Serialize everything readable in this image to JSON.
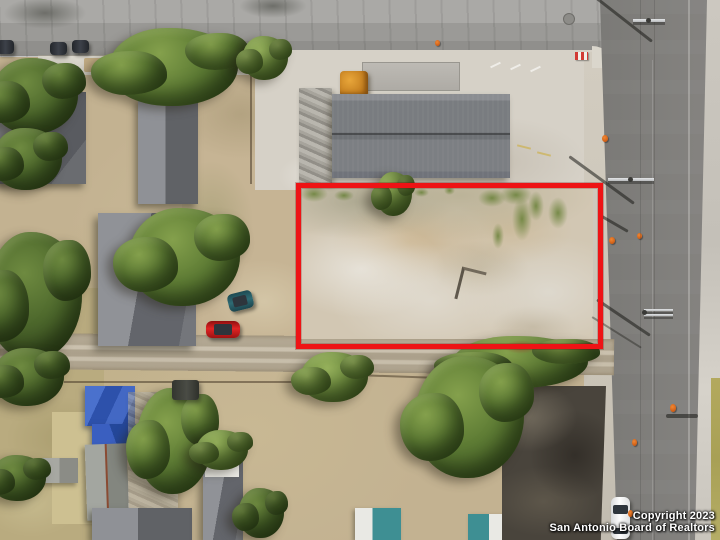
{
  "meta": {
    "type": "aerial-drone-real-estate-photo",
    "description": "Top-down aerial photograph of a vacant dirt lot outlined with a red property-boundary rectangle, bordered by a light horizontal street at top, a dark vertical street at right, residential houses and trees at left and bottom",
    "image_width": 720,
    "image_height": 540
  },
  "watermark": {
    "line1": "Copyright 2023",
    "line2": "San Antonio Board of Realtors",
    "text_color": "#ffffff"
  },
  "boundary": {
    "shape": "rectangle",
    "color": "#ee1315",
    "x": 296,
    "y": 183,
    "width": 297,
    "height": 156,
    "stroke_px": 5
  },
  "palette": {
    "dirt_lot": "#d2c7b3",
    "dirt_yard": "#c6b494",
    "dry_grass": "#b9ab7f",
    "road_top": "#9b9a97",
    "road_right": "#6a6967",
    "sidewalk": "#dad6cc",
    "concrete_pad": "#d6d1c7",
    "roof_main": "#797c80",
    "roof_dark": "#595b60",
    "flat_roof": "#49443c",
    "tarp_blue": "#3a5fc0",
    "tree_green": "#5d7b34",
    "car_red": "#e02424",
    "car_white": "#f4f4f4",
    "car_teal": "#2f6b74",
    "cone_orange": "#e8751f",
    "boundary_red": "#ee1315"
  },
  "objects": {
    "vacant_lot": "graded tan dirt lot with weeds along top edge and small green bush",
    "warehouse": "long gray shingle-roof building on white concrete pad above lot",
    "houses_left": "gray gable/hip roofs under heavy tree cover",
    "blue_tarp_roof": "house roof partly covered by blue tarps (bottom left)",
    "flat_roof_building": "dark flat-roof building at bottom right beside road",
    "vehicles": [
      "three dark cars parked on top street",
      "red car by middle driveway",
      "teal car in driveway",
      "dark pickup by alley",
      "white car driving on right street"
    ],
    "street_furniture": [
      "utility poles with crossarms and long shadows",
      "orange traffic cones",
      "manhole cover",
      "red-white marker sign"
    ]
  }
}
